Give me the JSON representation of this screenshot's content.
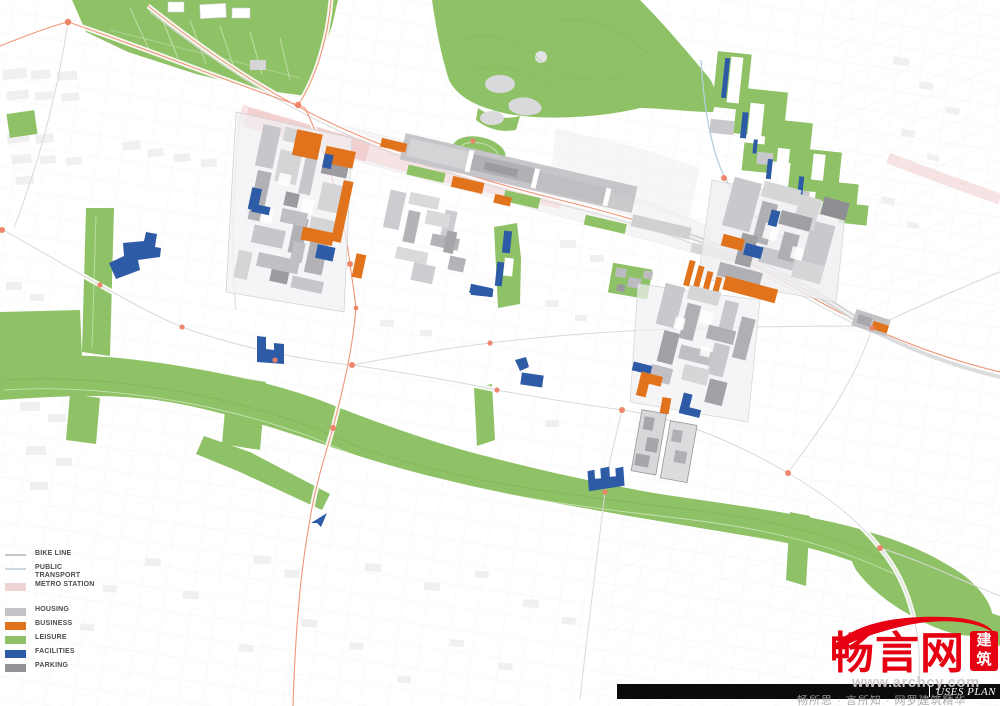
{
  "page": {
    "width": 1000,
    "height": 706,
    "background": "#ffffff"
  },
  "plan": {
    "title": "USES PLAN"
  },
  "legend": {
    "items": [
      {
        "id": "bike-line",
        "label": "BIKE LINE",
        "swatch": "line",
        "color": "#c6c6c6"
      },
      {
        "id": "public-transport",
        "label": "PUBLIC TRANSPORT",
        "swatch": "line",
        "color": "#ccd7de"
      },
      {
        "id": "metro-station",
        "label": "METRO STATION",
        "swatch": "area",
        "color": "#f0d4d4"
      },
      {
        "id": "housing",
        "label": "HOUSING",
        "swatch": "area",
        "color": "#c2c2c7"
      },
      {
        "id": "business",
        "label": "BUSINESS",
        "swatch": "area",
        "color": "#e2731d"
      },
      {
        "id": "leisure",
        "label": "LEISURE",
        "swatch": "area",
        "color": "#8fc266"
      },
      {
        "id": "facilities",
        "label": "FACILITIES",
        "swatch": "area",
        "color": "#2e5ba6"
      },
      {
        "id": "parking",
        "label": "PARKING",
        "swatch": "area",
        "color": "#939398"
      }
    ]
  },
  "watermark": {
    "brand": "畅言网",
    "badge_top": "建",
    "badge_bottom": "筑",
    "url": "www.archcy.com",
    "tagline": "畅所思 · 言所知 · 网罗建筑精华",
    "brand_color": "#e60012"
  },
  "footer": {
    "plan_label": "USES PLAN",
    "bar_color": "#0b0b0b"
  },
  "map_colors": {
    "leisure": "#8fc266",
    "business": "#e2731d",
    "facilities": "#2e5ba6",
    "housing_light": "#d8d8db",
    "housing_mid": "#c0c0c4",
    "parking_dark": "#9a9a9e",
    "metro_band": "#f6dede",
    "road_primary": "#ef8264",
    "road_secondary": "#d9d9d9",
    "rail_platform": "#c6c6ca",
    "bike_line": "#b5cedd"
  }
}
